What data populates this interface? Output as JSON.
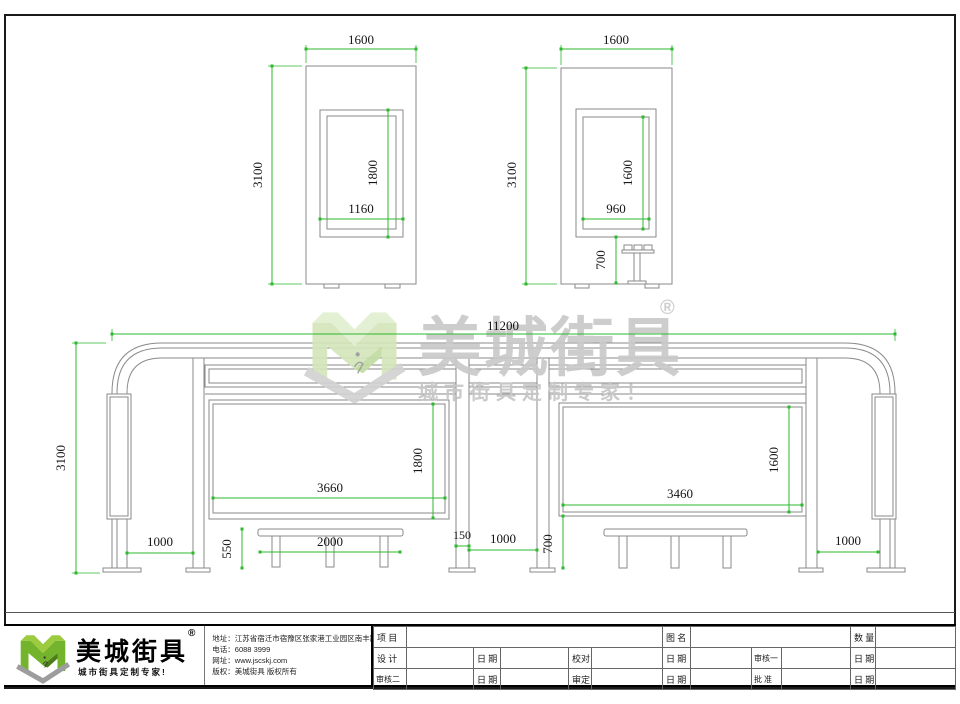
{
  "watermark": {
    "brand": "美城街具",
    "registered": "®",
    "tagline": "城市街具定制专家！"
  },
  "dims": {
    "side_a": {
      "width": "1600",
      "height": "3100",
      "screen_height": "1800",
      "screen_width": "1160"
    },
    "side_b": {
      "width": "1600",
      "height": "3100",
      "screen_height": "1600",
      "screen_width": "960",
      "seat_height": "700"
    },
    "front": {
      "total_width": "11200",
      "height": "3100",
      "left_panel_width": "3660",
      "left_panel_height": "1800",
      "right_panel_width": "3460",
      "right_panel_height": "1600",
      "left_end_bay": "1000",
      "bench_height": "550",
      "bench_length": "2000",
      "post_width": "150",
      "center_bay": "1000",
      "panel_bottom_height": "700",
      "right_end_bay": "1000"
    }
  },
  "title_block": {
    "logo": {
      "brand": "美城街具",
      "registered": "®",
      "tagline": "城市街具定制专家!"
    },
    "contact": {
      "address": "地址：江苏省宿迁市宿豫区张家港工业园区南丰路西侧1号",
      "phone": "电话：6088 3999",
      "website": "网址：www.jscskj.com",
      "copyright": "版权：美城街具 版权所有"
    },
    "table": {
      "r1": [
        "项 目",
        "图 名",
        "数 量"
      ],
      "r2": [
        "设 计",
        "日 期",
        "校对",
        "日 期",
        "审核一",
        "日 期"
      ],
      "r3": [
        "审核二",
        "日 期",
        "审定",
        "日 期",
        "批 准",
        "日 期"
      ]
    }
  }
}
